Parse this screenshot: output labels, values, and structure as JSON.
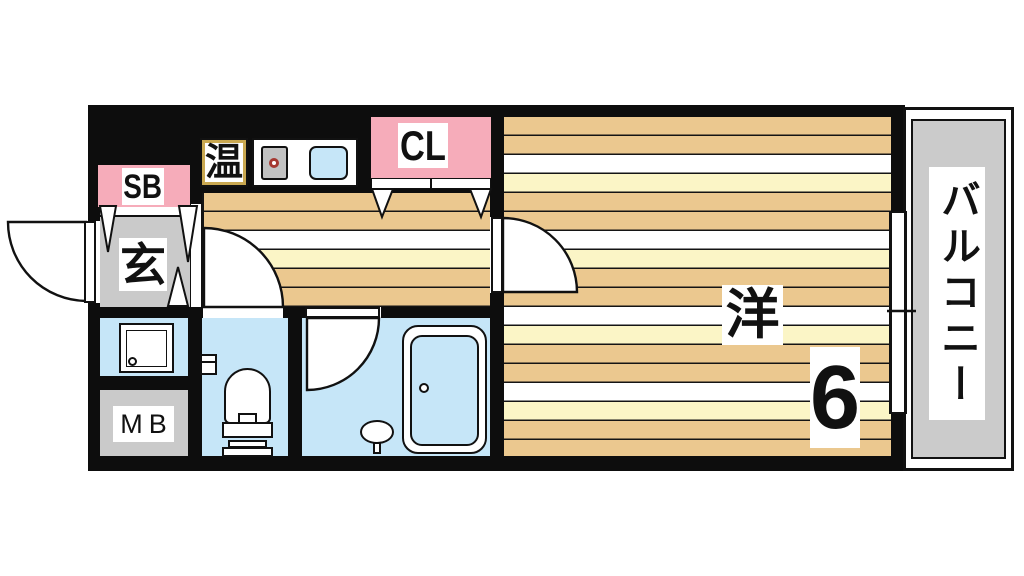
{
  "rooms": {
    "entrance": {
      "label": "玄"
    },
    "shoe_box": {
      "label": "SB"
    },
    "closet": {
      "label": "CL"
    },
    "water_heater": {
      "label": "温"
    },
    "meter_box": {
      "label": "MB"
    },
    "western_room": {
      "label": "洋",
      "size": "6"
    },
    "balcony": {
      "label": "バルコニー"
    }
  },
  "colors": {
    "wall": "#0d0d0d",
    "floor_tan": "#ebc88f",
    "floor_yellow": "#fbf5c6",
    "wet_room_blue": "#c6e6f8",
    "service_gray": "#cacaca",
    "closet_pink": "#f6acba",
    "burner_red": "#a53831",
    "heater_frame_gold": "#c9a851"
  }
}
